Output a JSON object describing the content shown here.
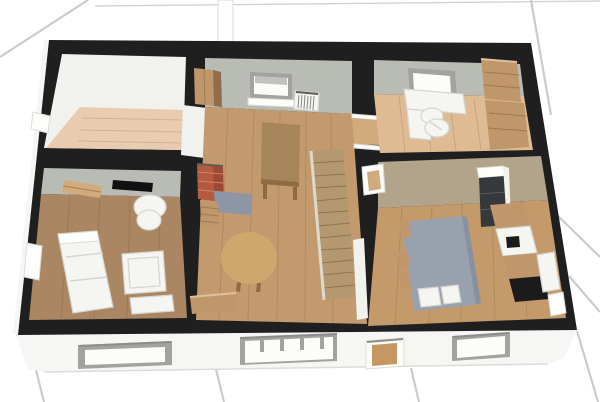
{
  "scene": {
    "type": "3d-floorplan-render",
    "description": "Aerial 3D cutaway view of a single-storey home standing on a white tiled ground",
    "ground": "white-tiles-perspective",
    "rooms": [
      {
        "id": "empty-room",
        "position": "top-left",
        "furniture": []
      },
      {
        "id": "living-room",
        "position": "bottom-left",
        "furniture": [
          "sofa",
          "armchair",
          "coffee-table",
          "wall-tv",
          "wall-shelf",
          "side-bench"
        ]
      },
      {
        "id": "hall",
        "position": "center",
        "furniture": [
          "wardrobe",
          "window",
          "radiator",
          "dining-table",
          "chimney",
          "hearth-mat",
          "drawer-chest",
          "round-table",
          "sideboard",
          "staircase"
        ]
      },
      {
        "id": "office",
        "position": "top-right",
        "furniture": [
          "wall-board",
          "desk",
          "office-chair",
          "shelving-unit"
        ]
      },
      {
        "id": "kitchen",
        "position": "bottom-right",
        "furniture": [
          "fridge",
          "counter-run",
          "sink",
          "cooktop",
          "dishwasher",
          "island-table",
          "chairs",
          "stools"
        ]
      }
    ],
    "front_openings": [
      "window",
      "multipane-window",
      "entry-door",
      "window"
    ]
  },
  "colors": {
    "bg": "#ffffff",
    "tile_line": "#c6c9cc",
    "wall_top": "#1f1f1f",
    "fascia": "#f6f6f4",
    "fascia_edge": "#dcdcd8",
    "frame_gray": "#a2a29e",
    "frame_dark": "#8c8c88",
    "glass": "#fcfcfb",
    "door_wood": "#c59862",
    "face_gray": "#b8bcb4",
    "face_white": "#f1f1ee",
    "face_beige": "#b2a48a",
    "floor_room1": "#e9ccb0",
    "floor_living": "#aa8662",
    "floor_hall": "#c39a6d",
    "floor_office": "#debb93",
    "floor_kitchen": "#c49a6a",
    "plank": "#5d4326",
    "white_furn": "#f5f5f1",
    "white_bright": "#fdfdfb",
    "furn_edge": "#d6d6d0",
    "wood_mid": "#bf976a",
    "wood_dark": "#8f6f4a",
    "wood_light": "#d2ab7c",
    "wood_hi": "#dcc39a",
    "table_brown": "#a7855b",
    "table_edge": "#8f6b44",
    "round_table": "#cda76e",
    "stair": "#b49870",
    "stair_line": "#8a6f4e",
    "stair_stringer": "#ded9cd",
    "brick": "#b45a40",
    "brick_side": "#9c4a34",
    "brick_line": "#cf8262",
    "cap_line": "#5c5c58",
    "mat_blue": "#8d96a4",
    "island": "#98a1ae",
    "island_side": "#8791a0",
    "tv": "#101010",
    "appliance": "#35393c",
    "appliance_line": "#565b5e",
    "black_detail": "#1b1b1b",
    "radiator_slat": "#6a6a66"
  }
}
